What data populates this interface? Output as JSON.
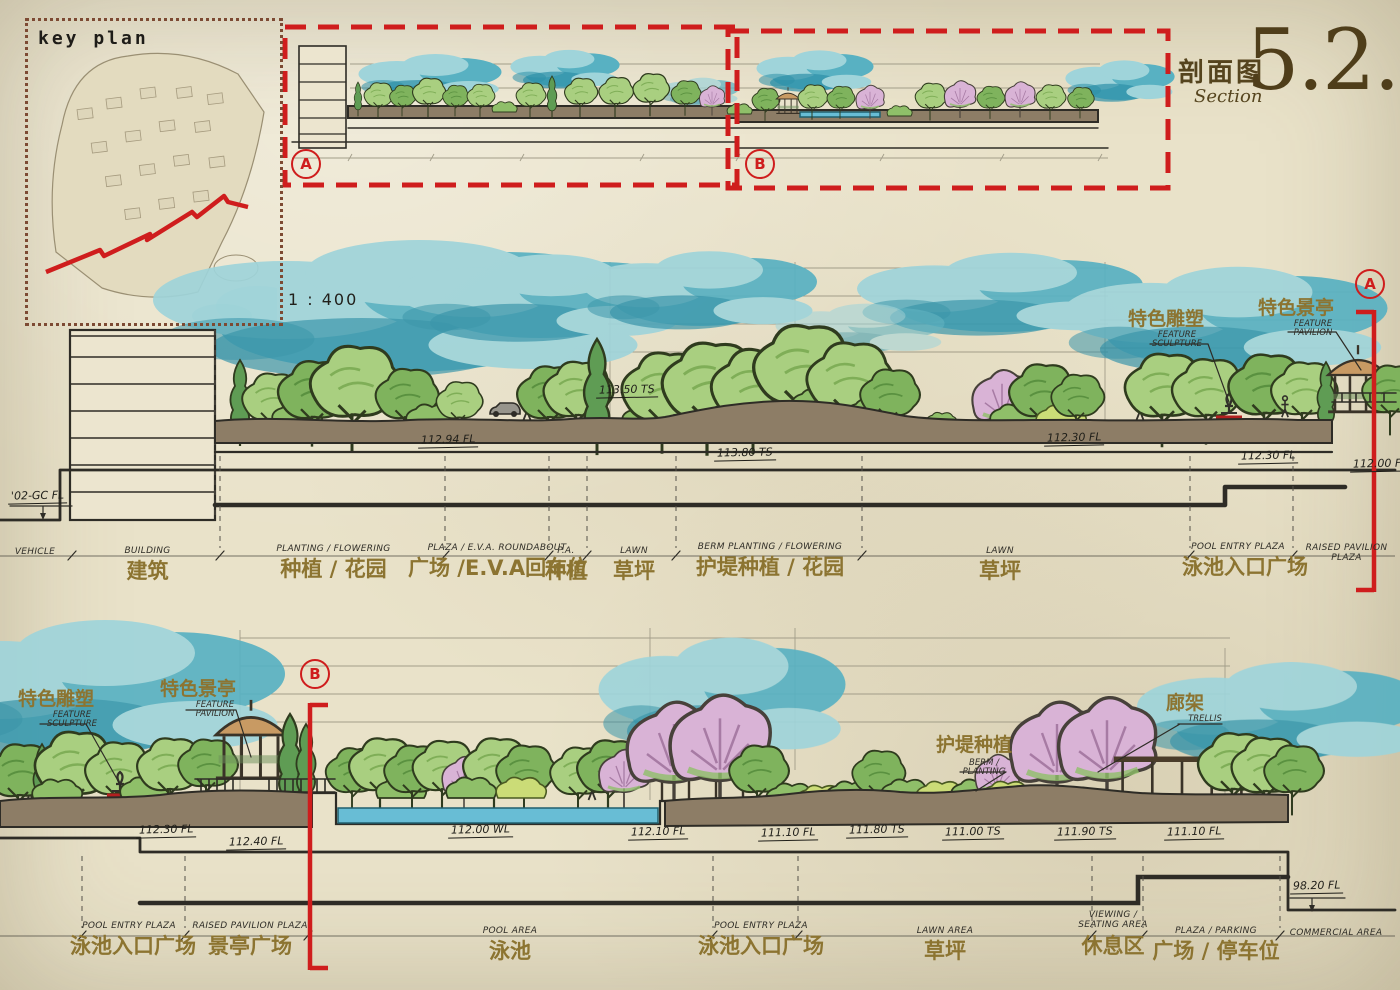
{
  "title": {
    "zh": "剖面图",
    "en": "Section",
    "number": "5.2.2"
  },
  "key_plan": {
    "label": "key plan"
  },
  "scale_label": "1 : 400",
  "colors": {
    "accent_red": "#cf1d1d",
    "label_olive": "#8c7431",
    "title_brown": "#4f3e1a",
    "sky_teal": "#58b1c2",
    "ground_brown": "#8d7d66"
  },
  "overview": {
    "marker_a": "A",
    "marker_b": "B"
  },
  "section_a": {
    "marker": "A",
    "datum_label": "'02-GC FL",
    "callouts": [
      {
        "zh": "特色雕塑",
        "en": "FEATURE SCULPTURE"
      },
      {
        "zh": "特色景亭",
        "en": "FEATURE PAVILION"
      }
    ],
    "elevations": [
      "112.94 FL",
      "113.50 TS",
      "113.80 TS",
      "112.30 FL",
      "112.30 FL",
      "112.00 FL"
    ],
    "zones": [
      {
        "en": "VEHICLE",
        "zh": ""
      },
      {
        "en": "BUILDING",
        "zh": "建筑"
      },
      {
        "en": "PLANTING / FLOWERING",
        "zh": "种植 / 花园"
      },
      {
        "en": "PLAZA / E.V.A. ROUNDABOUT",
        "zh": "广场 /E.V.A回车位"
      },
      {
        "en": "P.A.",
        "zh": "种植"
      },
      {
        "en": "LAWN",
        "zh": "草坪"
      },
      {
        "en": "BERM PLANTING / FLOWERING",
        "zh": "护堤种植 / 花园"
      },
      {
        "en": "LAWN",
        "zh": "草坪"
      },
      {
        "en": "POOL ENTRY PLAZA",
        "zh": "泳池入口广场"
      },
      {
        "en": "RAISED PAVILION PLAZA",
        "zh": ""
      }
    ]
  },
  "section_b": {
    "marker": "B",
    "callouts": [
      {
        "zh": "特色雕塑",
        "en": "FEATURE SCULPTURE"
      },
      {
        "zh": "特色景亭",
        "en": "FEATURE PAVILION"
      },
      {
        "zh": "护堤种植",
        "en": "BERM / PLANTING"
      },
      {
        "zh": "廊架",
        "en": "TRELLIS"
      }
    ],
    "elevations": [
      "112.30 FL",
      "112.40 FL",
      "112.00 WL",
      "112.10 FL",
      "111.10 FL",
      "111.80 TS",
      "111.00 TS",
      "111.90 TS",
      "111.10 FL",
      "98.20 FL"
    ],
    "zones": [
      {
        "en": "POOL ENTRY PLAZA",
        "zh": "泳池入口广场"
      },
      {
        "en": "RAISED PAVILION PLAZA",
        "zh": "景亭广场"
      },
      {
        "en": "POOL AREA",
        "zh": "泳池"
      },
      {
        "en": "POOL ENTRY PLAZA",
        "zh": "泳池入口广场"
      },
      {
        "en": "LAWN AREA",
        "zh": "草坪"
      },
      {
        "en": "VIEWING / SEATING AREA",
        "zh": "休息区"
      },
      {
        "en": "PLAZA / PARKING",
        "zh": "广场 / 停车位"
      },
      {
        "en": "COMMERCIAL AREA",
        "zh": ""
      }
    ]
  }
}
